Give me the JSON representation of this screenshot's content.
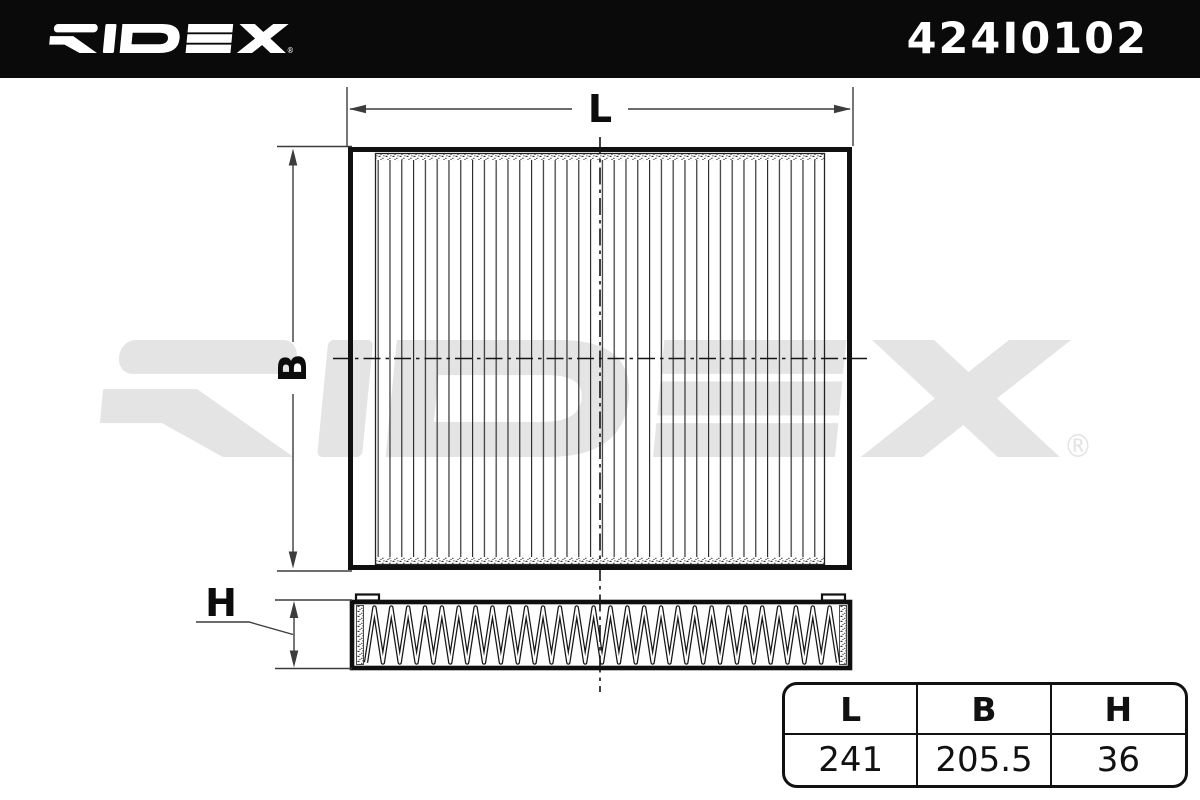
{
  "header": {
    "brand": "RIDEX",
    "registered_mark": "®",
    "part_number": "424I0102",
    "bg_color": "#0a0a0a",
    "fg_color": "#ffffff"
  },
  "watermark": {
    "brand": "RIDEX",
    "color": "#e4e4e4"
  },
  "drawing": {
    "type": "cabin-filter technical drawing, top view and side view",
    "labels": {
      "length": "L",
      "width": "B",
      "height": "H"
    },
    "frame_color": "#101010",
    "dim_line_color": "#3c3c3c"
  },
  "table": {
    "headers": [
      "L",
      "B",
      "H"
    ],
    "values": [
      "241",
      "205.5",
      "36"
    ]
  }
}
